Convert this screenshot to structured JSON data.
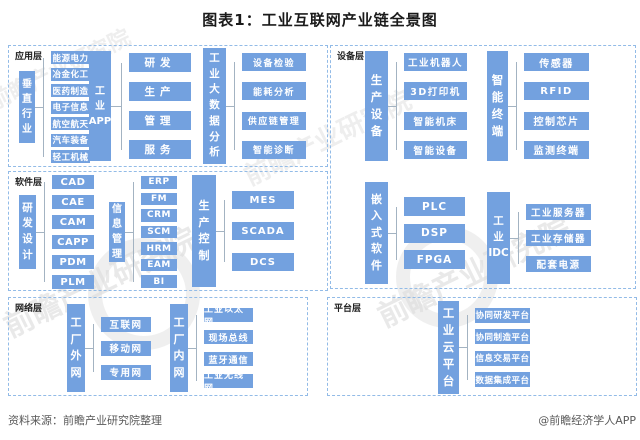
{
  "title": "图表1：工业互联网产业链全景图",
  "footer": {
    "source": "资料来源：前瞻产业研究院整理",
    "credit": "@前瞻经济学人APP"
  },
  "watermark": {
    "text": "前瞻产业研究院"
  },
  "colors": {
    "box_blue": "#73A1DF",
    "border_blue": "#92BBE7",
    "connector_gray": "#A3B3C2"
  },
  "sections": [
    {
      "label": "应用层",
      "groups": [
        {
          "header": "垂\n直\n行\n业",
          "items": [
            "能源电力",
            "冶金化工",
            "医药制造",
            "电子信息",
            "航空航天",
            "汽车装备",
            "轻工机械"
          ]
        },
        {
          "header": "工\n业\nAPP",
          "items": [
            "研发",
            "生产",
            "管理",
            "服务"
          ]
        },
        {
          "header": "工\n业\n大\n数\n据\n分\n析",
          "items": [
            "设备检验",
            "能耗分析",
            "供应链管理",
            "智能诊断"
          ]
        }
      ]
    },
    {
      "label": "软件层",
      "groups": [
        {
          "header": "研\n发\n设\n计",
          "items": [
            "CAD",
            "CAE",
            "CAM",
            "CAPP",
            "PDM",
            "PLM"
          ]
        },
        {
          "header": "信\n息\n管\n理",
          "items": [
            "ERP",
            "FM",
            "CRM",
            "SCM",
            "HRM",
            "EAM",
            "BI"
          ]
        },
        {
          "header": "生\n产\n控\n制",
          "items": [
            "MES",
            "SCADA",
            "DCS"
          ]
        }
      ]
    },
    {
      "label": "网络层",
      "groups": [
        {
          "header": "工\n厂\n外\n网",
          "items": [
            "互联网",
            "移动网",
            "专用网"
          ]
        },
        {
          "header": "工\n厂\n内\n网",
          "items": [
            "工业以太网",
            "现场总线",
            "蓝牙通信",
            "工业无线网"
          ]
        }
      ]
    },
    {
      "label": "设备层",
      "groups": [
        {
          "header": "生\n产\n设\n备",
          "items": [
            "工业机器人",
            "3D打印机",
            "智能机床",
            "智能设备"
          ]
        },
        {
          "header": "智\n能\n终\n端",
          "items": [
            "传感器",
            "RFID",
            "控制芯片",
            "监测终端"
          ]
        },
        {
          "header": "嵌\n入\n式\n软\n件",
          "items": [
            "PLC",
            "DSP",
            "FPGA"
          ]
        },
        {
          "header": "工\n业\nIDC",
          "items": [
            "工业服务器",
            "工业存储器",
            "配套电源"
          ]
        }
      ]
    },
    {
      "label": "平台层",
      "groups": [
        {
          "header": "工\n业\n云\n平\n台",
          "items": [
            "协同研发平台",
            "协同制造平台",
            "信息交易平台",
            "数据集成平台"
          ]
        }
      ]
    }
  ]
}
